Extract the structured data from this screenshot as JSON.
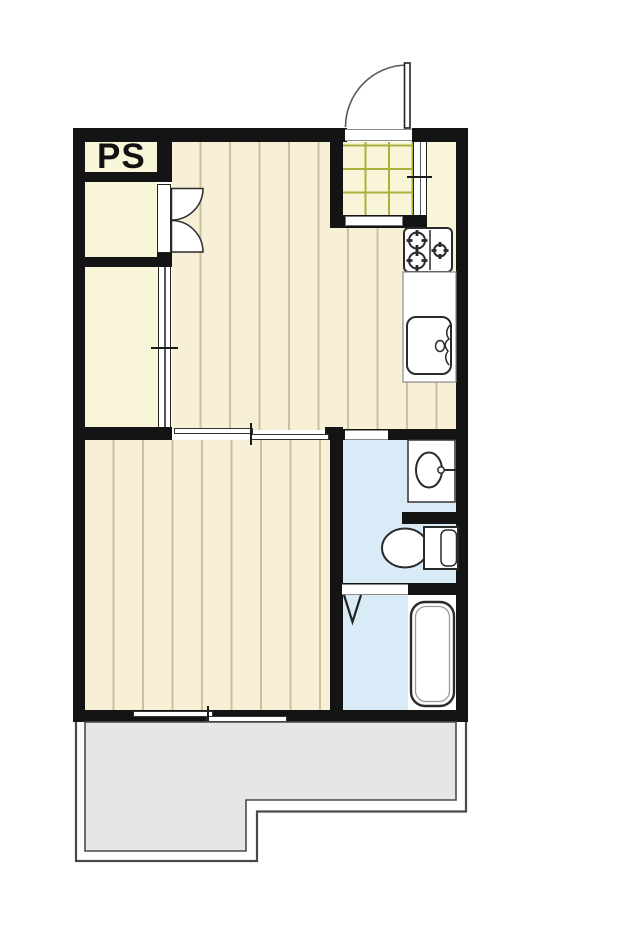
{
  "plan": {
    "label_ps": "PS",
    "colors": {
      "wall": "#141414",
      "floor": "#f8efd7",
      "floor-line": "#cdc09b",
      "closet": "#f9f5d9",
      "tile-line": "#a9b23c",
      "water": "#d9ebf7",
      "balcony": "#e6e6e6",
      "balcony-line": "#4a4a4a",
      "fixture-stroke": "#2a2a2a"
    }
  }
}
